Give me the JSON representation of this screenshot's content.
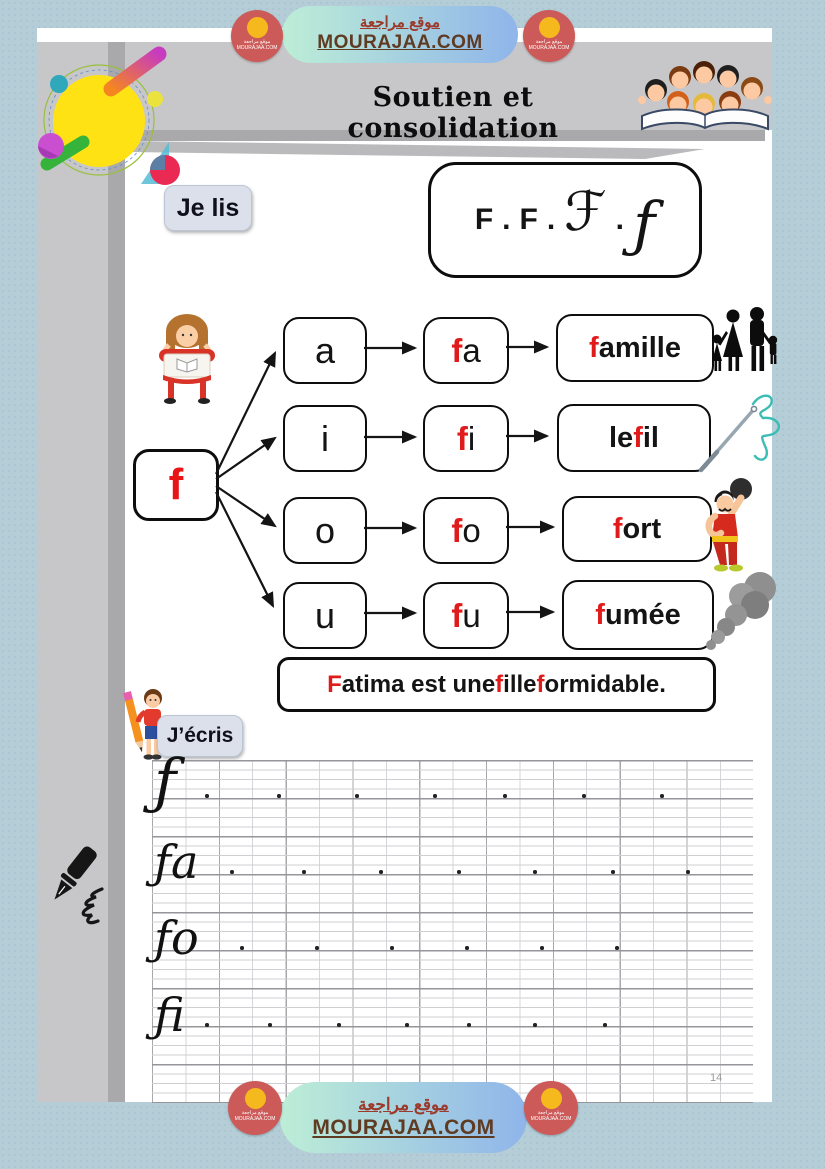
{
  "colors": {
    "accent_red": "#e01b1b",
    "page_blue": "#b4cdd7",
    "gray_band": "#c7c7c9",
    "gray_dark": "#a9a9ab",
    "brand_brown": "#5f3b22",
    "brand_red_ar": "#9c3a2b",
    "logo_red": "#cc5a58",
    "logo_yellow": "#f5b91d"
  },
  "header": {
    "site_name_ar": "موقع مراجعة",
    "site_name_en": "MOURAJAA.COM",
    "title": "Soutien et consolidation"
  },
  "footer": {
    "site_name_ar": "موقع مراجعة",
    "site_name_en": "MOURAJAA.COM",
    "page_number": "14"
  },
  "je_lis": {
    "label": "Je lis",
    "forms": [
      {
        "glyph": "F",
        "style": "print"
      },
      {
        "glyph": "F",
        "style": "print"
      },
      {
        "glyph": "ℱ",
        "style": "script-cap"
      },
      {
        "glyph": "ƒ",
        "style": "script-low"
      }
    ]
  },
  "diagram": {
    "root_letter": "f",
    "rows": [
      {
        "vowel": "a",
        "syllable": [
          {
            "t": "f",
            "red": true
          },
          {
            "t": "a"
          }
        ],
        "word": [
          {
            "t": "f",
            "red": true
          },
          {
            "t": "a",
            "bold": true
          },
          {
            "t": "mille"
          }
        ]
      },
      {
        "vowel": "i",
        "syllable": [
          {
            "t": "f",
            "red": true
          },
          {
            "t": "i"
          }
        ],
        "word": [
          {
            "t": "le "
          },
          {
            "t": "f",
            "red": true
          },
          {
            "t": "il"
          }
        ]
      },
      {
        "vowel": "o",
        "syllable": [
          {
            "t": "f",
            "red": true
          },
          {
            "t": "o"
          }
        ],
        "word": [
          {
            "t": "f",
            "red": true
          },
          {
            "t": "o",
            "bold": true
          },
          {
            "t": "rt"
          }
        ]
      },
      {
        "vowel": "u",
        "syllable": [
          {
            "t": "f",
            "red": true
          },
          {
            "t": "u"
          }
        ],
        "word": [
          {
            "t": "f",
            "red": true
          },
          {
            "t": "u",
            "bold": true
          },
          {
            "t": "mée"
          }
        ]
      }
    ],
    "sentence": [
      {
        "t": "F",
        "red": true
      },
      {
        "t": "atima est une "
      },
      {
        "t": "f",
        "red": true
      },
      {
        "t": "ille "
      },
      {
        "t": "f",
        "red": true
      },
      {
        "t": "ormidable."
      }
    ]
  },
  "j_ecris": {
    "label": "J’écris",
    "practice_rows": [
      {
        "letters": "f",
        "glyph": "ƒ",
        "dots": [
          53,
          125,
          203,
          281,
          351,
          430,
          508
        ]
      },
      {
        "letters": "fa",
        "glyph": "ƒa",
        "dots": [
          78,
          150,
          227,
          305,
          381,
          459,
          534
        ]
      },
      {
        "letters": "fo",
        "glyph": "ƒo",
        "dots": [
          88,
          163,
          238,
          313,
          388,
          463
        ]
      },
      {
        "letters": "fi",
        "glyph": "ƒi",
        "dots": [
          53,
          116,
          185,
          253,
          315,
          381,
          451
        ]
      }
    ]
  },
  "cliparts": {
    "top_right": "children-reading-open-book",
    "je_lis": "girl-reading-at-desk",
    "famille": "family-silhouette",
    "fil": "needle-and-thread",
    "fort": "strongman-lifting-weight",
    "fumee": "smoke-plume",
    "margin": "fountain-pen-writing",
    "j_ecris": "child-with-pencil",
    "corner": "sun-orbit-decoration"
  }
}
